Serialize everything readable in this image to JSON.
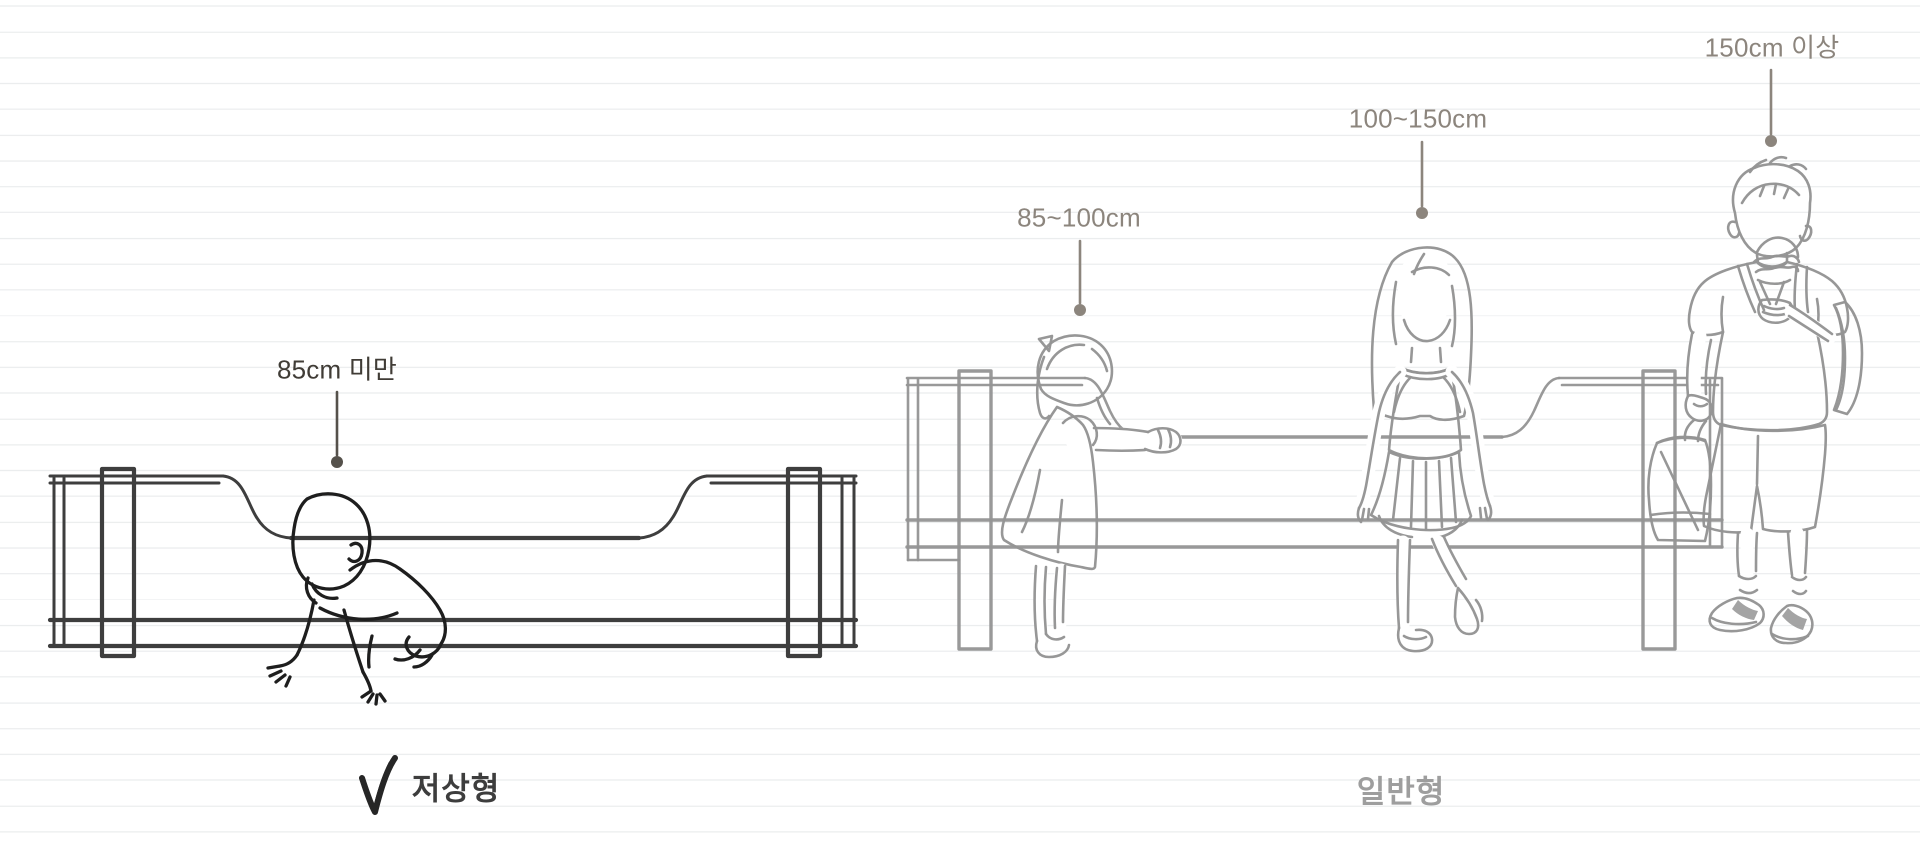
{
  "illustration": {
    "title_hint": "bed height comparison sketch",
    "low_bed_group": {
      "height_label": "85cm 미만",
      "type_label": "저상형",
      "selected": true,
      "figure": "crawling-baby"
    },
    "standard_bed_group": {
      "height_labels": [
        "85~100cm",
        "100~150cm",
        "150cm 이상"
      ],
      "type_label": "일반형",
      "selected": false,
      "figures": [
        "toddler-girl",
        "school-girl",
        "boy-with-backpack"
      ]
    },
    "icons": {
      "checkmark": "checkmark-icon"
    },
    "colors": {
      "dark_label": "#403C36",
      "muted_label": "#8C857D",
      "dark_sketch": "#3E3E3E",
      "baby_ink": "#1E1E1E",
      "light_sketch": "#949494",
      "type_label_dark": "#3D3D3D",
      "type_label_light": "#9E9E9E",
      "checkmark": "#262626",
      "ruled_line": "#EBEDEE",
      "background": "#FFFFFF"
    }
  }
}
